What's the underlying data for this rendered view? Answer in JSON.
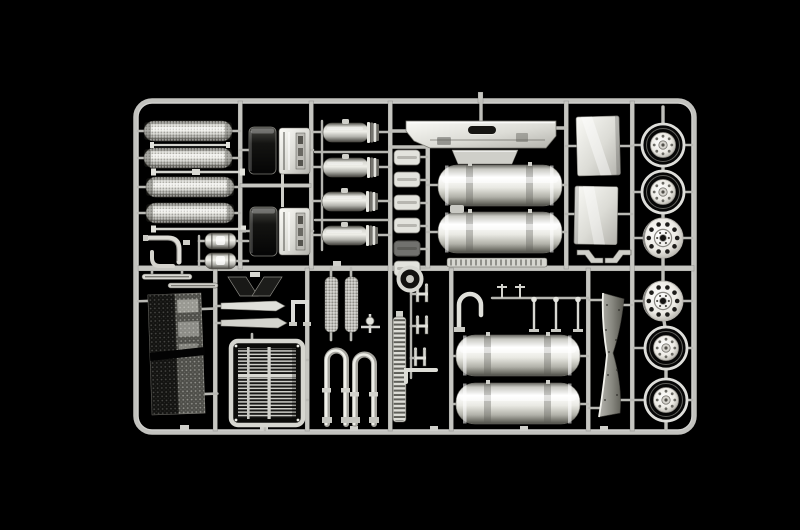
{
  "scene": {
    "description": "Photograph of a chrome-plated plastic model-kit sprue with truck detail parts on a black background",
    "type": "photograph",
    "colors": {
      "background": "#000000",
      "runner": "#c6c6c1",
      "chrome_highlight": "#ffffff",
      "chrome_light": "#efefe9",
      "chrome_mid": "#b3b2ac",
      "chrome_shadow": "#55544e",
      "dark_reflection": "#141412"
    }
  },
  "sprue": {
    "material": "chrome-plated styrene",
    "layout": "rectangular frame, two rows of compartments, wheel column on right"
  },
  "parts": [
    {
      "name": "knurled air-cleaner drum",
      "count": 4,
      "location": "top-left"
    },
    {
      "name": "tie rod",
      "count": 3,
      "location": "top-left"
    },
    {
      "name": "exhaust elbow pipe",
      "count": 2,
      "location": "mid-left"
    },
    {
      "name": "air reservoir canister",
      "count": 2,
      "location": "mid-left"
    },
    {
      "name": "dark chrome step panel",
      "count": 2,
      "location": "top-left"
    },
    {
      "name": "battery box panel",
      "count": 2,
      "location": "top-left"
    },
    {
      "name": "small air tank",
      "count": 4,
      "location": "top-center-left"
    },
    {
      "name": "front bumper",
      "count": 1,
      "location": "top-center"
    },
    {
      "name": "bumper step plate",
      "count": 1,
      "location": "top-center"
    },
    {
      "name": "large fuel tank",
      "count": 4,
      "location": "center and bottom-center"
    },
    {
      "name": "leaf strip plate",
      "count": 6,
      "location": "center-left column"
    },
    {
      "name": "tread strip",
      "count": 1,
      "location": "center"
    },
    {
      "name": "horn ring",
      "count": 1,
      "location": "center"
    },
    {
      "name": "cab side panel",
      "count": 2,
      "location": "top-right of tanks"
    },
    {
      "name": "z-bracket",
      "count": 2,
      "location": "center-right"
    },
    {
      "name": "deep-dish wheel rim",
      "count": 4,
      "location": "right column"
    },
    {
      "name": "flat wheel disc",
      "count": 2,
      "location": "right column"
    },
    {
      "name": "perforated mesh screen",
      "count": 1,
      "location": "bottom-left"
    },
    {
      "name": "radiator grille",
      "count": 1,
      "location": "bottom-left"
    },
    {
      "name": "pointed trim strip",
      "count": 2,
      "location": "bottom-left"
    },
    {
      "name": "dark wedge bracket",
      "count": 2,
      "location": "bottom-left"
    },
    {
      "name": "u-bracket",
      "count": 1,
      "location": "bottom-left"
    },
    {
      "name": "perforated heat-shield strap",
      "count": 2,
      "location": "bottom-center-left"
    },
    {
      "name": "exhaust u-pipe",
      "count": 2,
      "location": "bottom-center-left"
    },
    {
      "name": "ladder tread strip",
      "count": 1,
      "location": "bottom-center"
    },
    {
      "name": "mirror bracket",
      "count": 3,
      "location": "bottom-center"
    },
    {
      "name": "hook pipe",
      "count": 1,
      "location": "bottom-center"
    },
    {
      "name": "stanchion rod",
      "count": 3,
      "location": "bottom-center"
    },
    {
      "name": "wiper strip",
      "count": 2,
      "location": "below middle rail, left"
    },
    {
      "name": "aero deflector blade",
      "count": 1,
      "location": "bottom-right"
    }
  ]
}
